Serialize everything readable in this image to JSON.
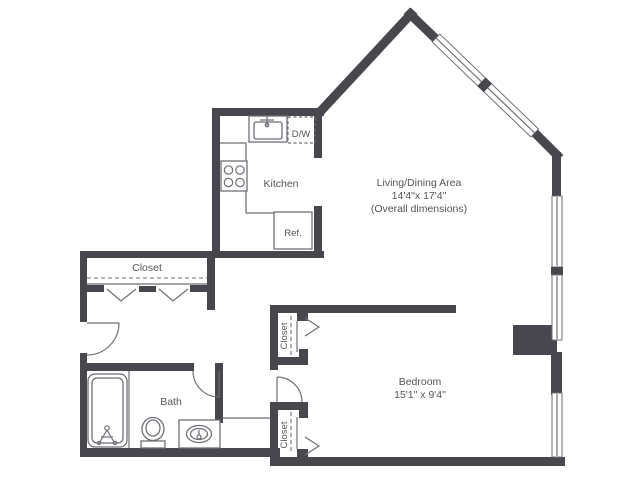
{
  "image": {
    "width": 640,
    "height": 480,
    "type": "apartment-floor-plan"
  },
  "colors": {
    "wall": "#47474d",
    "line": "#6f6f76",
    "text": "#54545a",
    "bg": "#ffffff"
  },
  "labels": {
    "kitchen": "Kitchen",
    "dishwasher": "D/W",
    "refrigerator": "Ref.",
    "hall_closet": "Closet",
    "bath": "Bath",
    "bedroom_closet_top": "Closet",
    "bedroom_closet_bottom": "Closet",
    "living_line1": "Living/Dining Area",
    "living_line2": "14'4\"x 17'4\"",
    "living_line3": "(Overall dimensions)",
    "bedroom_line1": "Bedroom",
    "bedroom_line2": "15'1\" x 9'4\""
  }
}
